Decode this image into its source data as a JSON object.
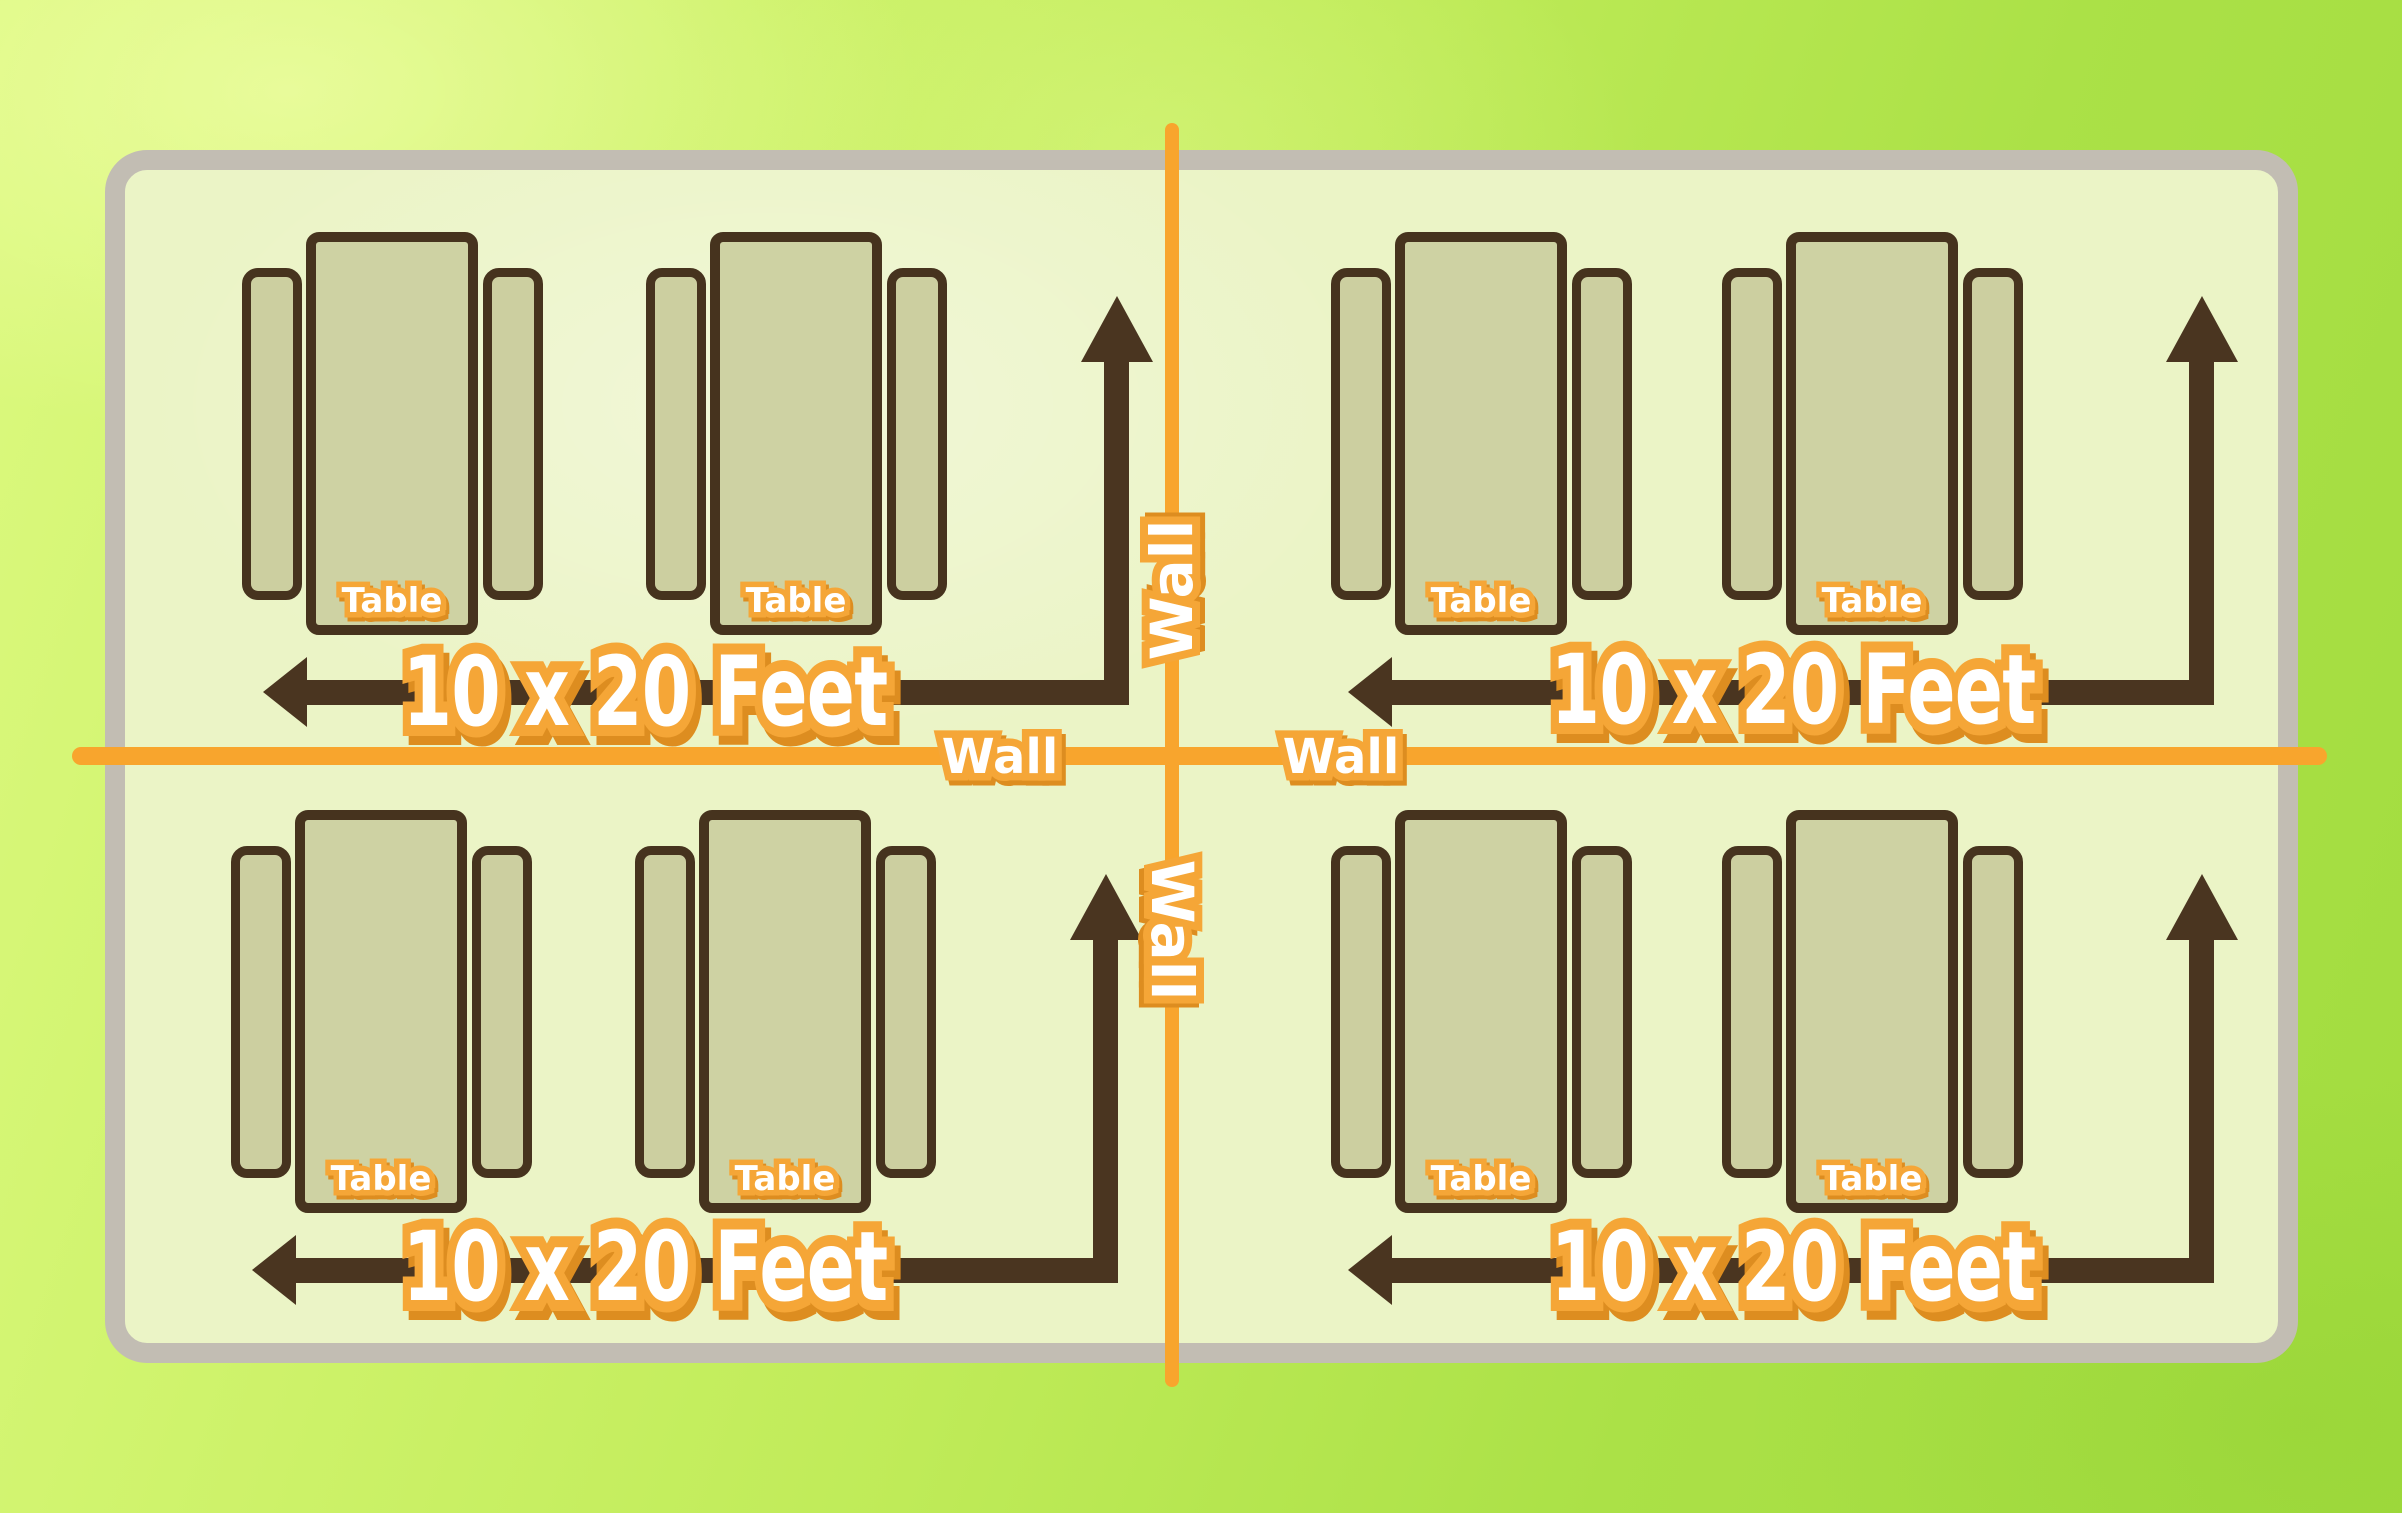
{
  "floor_plan": {
    "wall_labels": {
      "horizontal_left": "Wall",
      "horizontal_right": "Wall",
      "vertical_upper": "Wall",
      "vertical_lower": "Wall"
    },
    "quadrants": [
      {
        "name": "top-left",
        "size_label": "10 x 20 Feet",
        "tables": [
          {
            "label": "Table"
          },
          {
            "label": "Table"
          }
        ]
      },
      {
        "name": "top-right",
        "size_label": "10 x 20 Feet",
        "tables": [
          {
            "label": "Table"
          },
          {
            "label": "Table"
          }
        ]
      },
      {
        "name": "bottom-left",
        "size_label": "10 x 20 Feet",
        "tables": [
          {
            "label": "Table"
          },
          {
            "label": "Table"
          }
        ]
      },
      {
        "name": "bottom-right",
        "size_label": "10 x 20 Feet",
        "tables": [
          {
            "label": "Table"
          },
          {
            "label": "Table"
          }
        ]
      }
    ],
    "colors": {
      "background_green": "#bfe95a",
      "room_fill": "#ebf4c6",
      "room_border_gray": "#c2bdb3",
      "wall_line_orange": "#f8a52d",
      "table_fill": "#ced2a3",
      "table_border_brown": "#46331e",
      "arrow_brown": "#4a3520",
      "label_fill_white": "#ffffff",
      "label_outline_orange": "#f5a637",
      "label_shadow_orange": "#dd8d20"
    }
  }
}
